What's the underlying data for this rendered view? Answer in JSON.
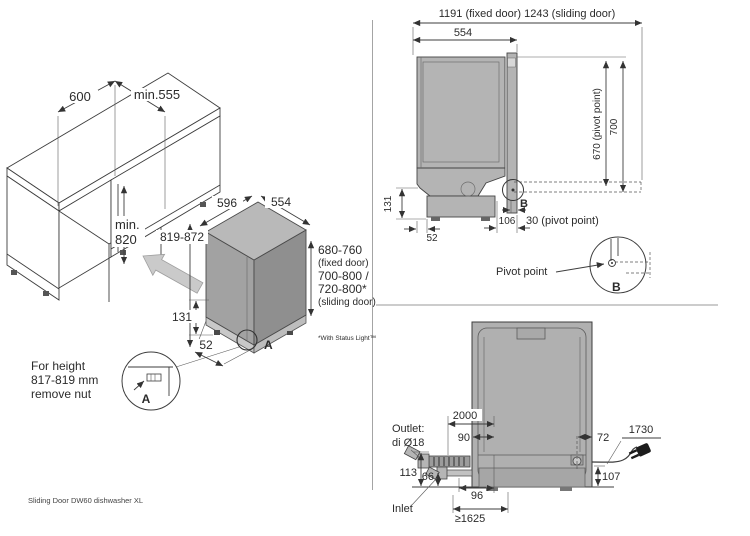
{
  "caption": "Sliding Door DW60 dishwasher XL",
  "installation": {
    "niche_width": "600",
    "niche_depth": "min.555",
    "niche_height_line1": "min.",
    "niche_height_line2": "820",
    "unit_width": "596",
    "unit_depth": "554",
    "unit_height": "819-872",
    "base_height": "131",
    "foot_inset": "52",
    "door_fixed_value": "680-760",
    "door_fixed_note": "(fixed door)",
    "door_sliding_value_1": "700-800 /",
    "door_sliding_value_2": "720-800*",
    "door_sliding_note": "(sliding door)",
    "footnote": "*With Status Light™",
    "corner_marker": "A",
    "note": {
      "line1": "For height",
      "line2": "817-819 mm",
      "line3": "remove nut",
      "detail_label": "A"
    }
  },
  "side_view": {
    "overall_width": "1191 (fixed door) 1243 (sliding door)",
    "depth": "554",
    "pivot_height": "670 (pivot point)",
    "top_height": "700",
    "base_height": "131",
    "back_offset": "52",
    "base_front_offset": "106",
    "pivot_offset": "30 (pivot point)",
    "detail_label": "B"
  },
  "pivot_detail": {
    "label": "Pivot point",
    "detail_label": "B"
  },
  "rear_view": {
    "drain_hose_length": "2000",
    "drain_offset_left": "90",
    "drain_offset_right": "72",
    "cord_length": "1730",
    "outlet_line1": "Outlet:",
    "outlet_line2": "di Ø18",
    "outlet_height": "113",
    "inlet_height": "66",
    "inlet_offset": "96",
    "cord_height": "107",
    "inlet_label": "Inlet",
    "hose_min_length": "≥1625"
  },
  "colors": {
    "unit_gray": "#a2a2a2",
    "line": "#3d3d3d"
  }
}
